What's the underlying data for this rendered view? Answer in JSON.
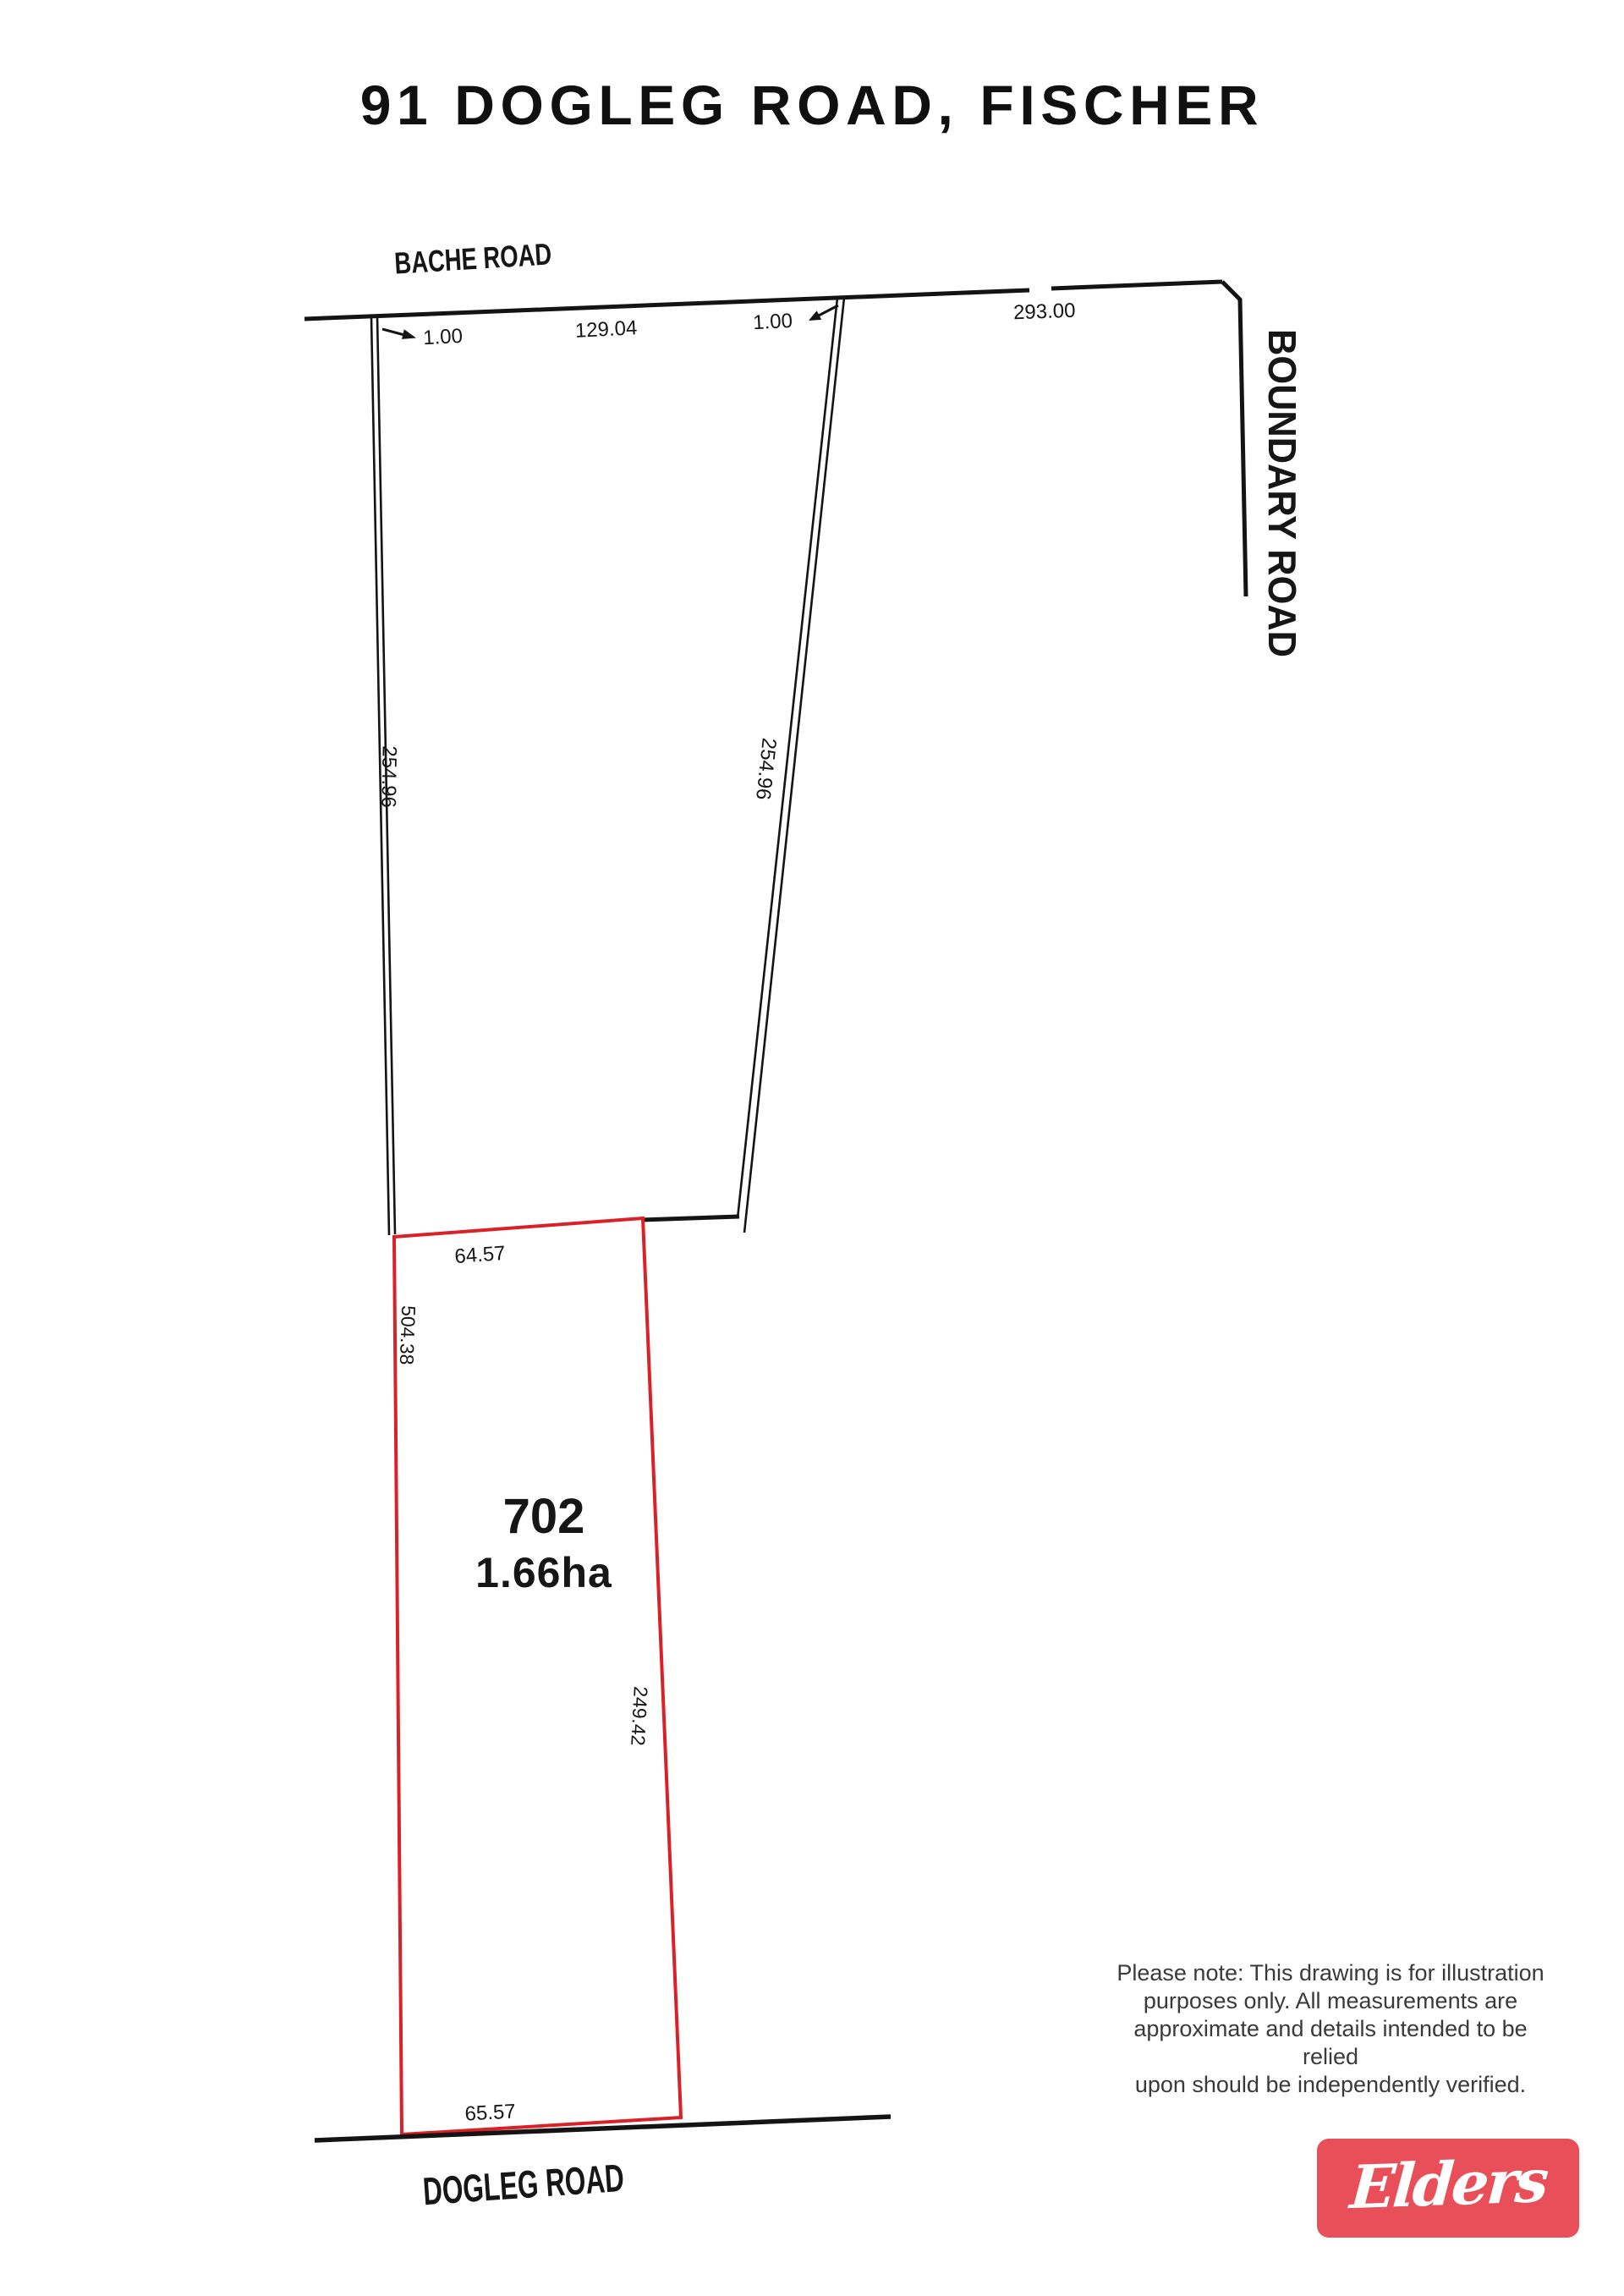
{
  "page": {
    "title": "91 DOGLEG ROAD, FISCHER"
  },
  "plan": {
    "roads": {
      "top": "BACHE ROAD",
      "right": "BOUNDARY ROAD",
      "bottom": "DOGLEG ROAD"
    },
    "lot": {
      "number": "702",
      "area": "1.66ha"
    },
    "dimensions": {
      "top_left_offset": "1.00",
      "top_frontage": "129.04",
      "top_right_offset": "1.00",
      "top_total": "293.00",
      "left_side": "254.96",
      "right_side": "254.96",
      "lot_top": "64.57",
      "lot_left": "504.38",
      "lot_right": "249.42",
      "lot_bottom": "65.57"
    }
  },
  "disclaimer": {
    "lines": [
      "Please note: This drawing is for illustration",
      "purposes only. All measurements are",
      "approximate and details intended to be relied",
      "upon should be independently verified."
    ]
  },
  "logo": {
    "brand": "Elders"
  },
  "colors": {
    "ink": "#141414",
    "lot": "#d92127",
    "logo": "#e94f58",
    "muted": "#3a3a3a"
  }
}
